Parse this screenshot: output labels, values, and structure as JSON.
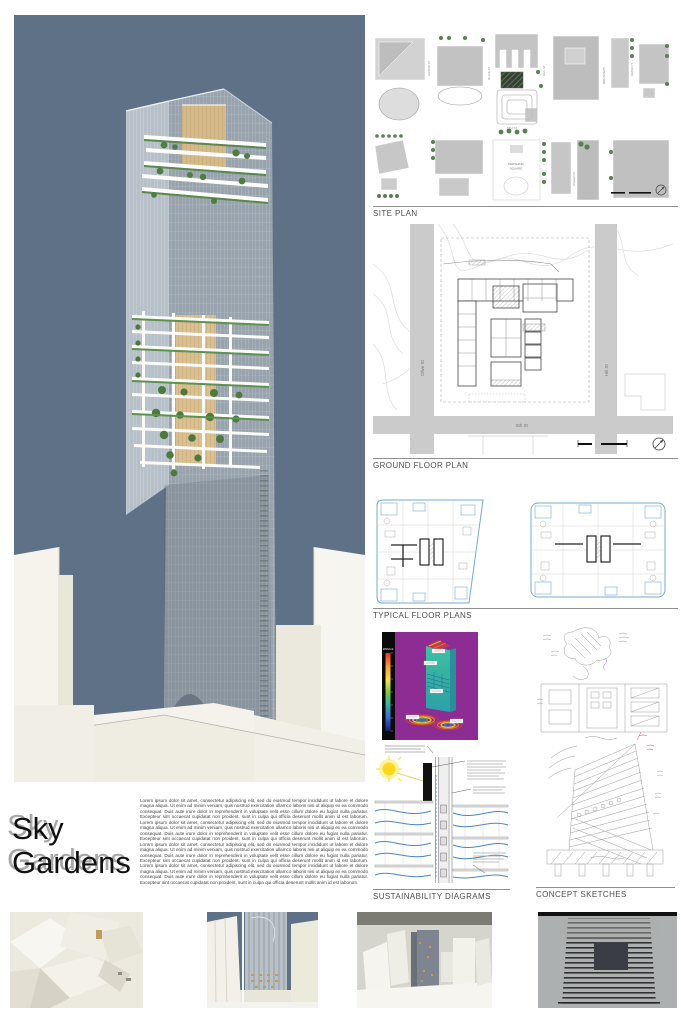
{
  "title": {
    "line1": "Sky",
    "line2": "Gardens"
  },
  "description": "Lorem ipsum dolor sit amet, consectetur adipiscing elit, sed do eiusmod tempor incididunt ut labore et dolore magna aliqua. Ut enim ad minim veniam, quis nostrud exercitation ullamco laboris nisi ut aliquip ex ea commodo consequat. Duis aute irure dolor in reprehenderit in voluptate velit esse cillum dolore eu fugiat nulla pariatur. Excepteur sint occaecat cupidatat non proident, sunt in culpa qui officia deserunt mollit anim id est laborum. Lorem ipsum dolor sit amet, consectetur adipiscing elit, sed do eiusmod tempor incididunt ut labore et dolore magna aliqua. Ut enim ad minim veniam, quis nostrud exercitation ullamco laboris nisi ut aliquip ex ea commodo consequat. Duis aute irure dolor in reprehenderit in voluptate velit esse cillum dolore eu fugiat nulla pariatur. Excepteur sint occaecat cupidatat non proident, sunt in culpa qui officia deserunt mollit anim id est laborum. Lorem ipsum dolor sit amet, consectetur adipiscing elit, sed do eiusmod tempor incididunt ut labore et dolore magna aliqua. Ut enim ad minim veniam, quis nostrud exercitation ullamco laboris nisi ut aliquip ex ea commodo consequat. Duis aute irure dolor in reprehenderit in voluptate velit esse cillum dolore eu fugiat nulla pariatur. Excepteur sint occaecat cupidatat non proident, sunt in culpa qui officia deserunt mollit anim id est laborum. Lorem ipsum dolor sit amet, consectetur adipiscing elit, sed do eiusmod tempor incididunt ut labore et dolore magna aliqua. Ut enim ad minim veniam, quis nostrud exercitation ullamco laboris nisi ut aliquip ex ea commodo consequat. Duis aute irure dolor in reprehenderit in voluptate velit esse cillum dolore eu fugiat nulla pariatur. Excepteur sint occaecat cupidatat non proident, sunt in culpa qui officia deserunt mollit anim id est laborum.",
  "sections": {
    "site_plan": {
      "label": "SITE PLAN",
      "streets": {
        "grand": "GRAND ST",
        "olive": "OLIVE ST",
        "hill": "HILL ST",
        "lindley": "LINDLEY PL",
        "broadway": "BROADWAY",
        "frank": "FRANK CT",
        "fifth": "5TH ST"
      },
      "square_line1": "PERSHING",
      "square_line2": "SQUARE"
    },
    "ground_floor_plan": {
      "label": "GROUND FLOOR PLAN",
      "streets": {
        "left": "Olive St",
        "right": "Hill St",
        "bottom": "5th St"
      }
    },
    "typical_floor_plans": {
      "label": "TYPICAL FLOOR PLANS"
    },
    "sustainability": {
      "label": "SUSTAINABILITY DIAGRAMS",
      "scale_unit": "kWh/m2"
    },
    "concept_sketches": {
      "label": "CONCEPT SKETCHES"
    }
  },
  "colors": {
    "sky": "#5e7187",
    "accent_blue": "#74a9d2",
    "solar_purple": "#8d2c93",
    "garden_green": "#4c7a3e",
    "wood": "#d4b98a"
  }
}
